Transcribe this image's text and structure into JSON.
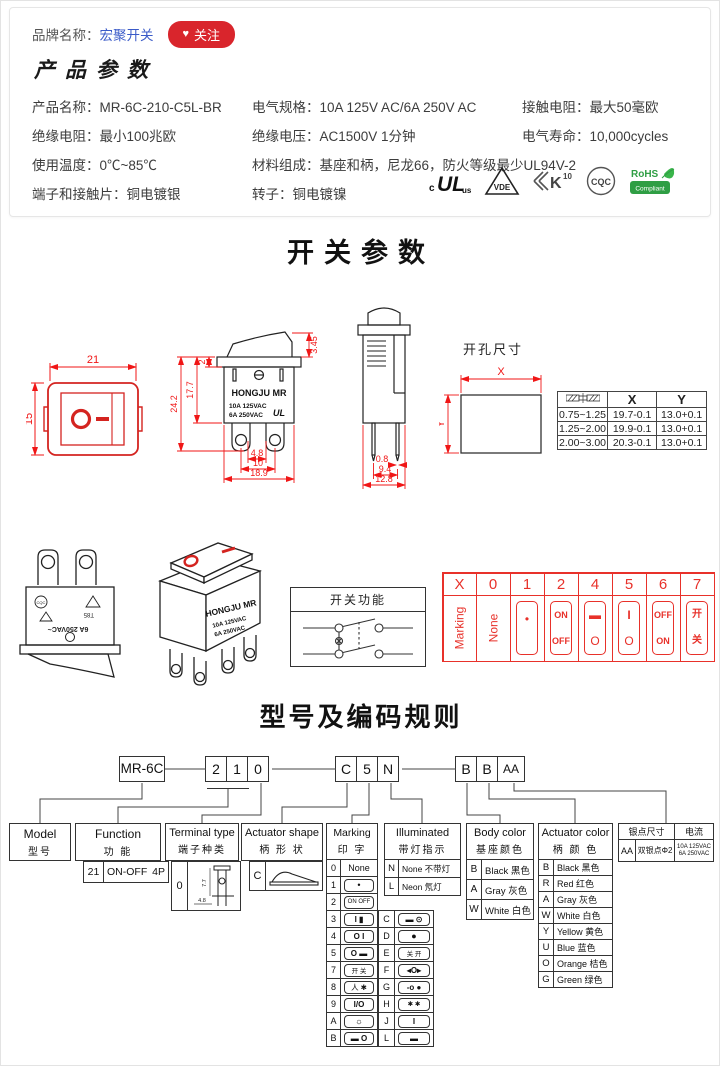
{
  "header": {
    "brand_label": "品牌名称：",
    "brand_name": "宏聚开关",
    "follow_label": "关注",
    "follow_heart": "♥"
  },
  "product": {
    "title": "产品参数",
    "specs": [
      {
        "label": "产品名称：",
        "value": "MR-6C-210-C5L-BR"
      },
      {
        "label": "电气规格：",
        "value": "10A 125V AC/6A 250V AC"
      },
      {
        "label": "接触电阻：",
        "value": "最大50毫欧"
      },
      {
        "label": "绝缘电阻：",
        "value": "最小100兆欧"
      },
      {
        "label": "绝缘电压：",
        "value": "AC1500V 1分钟"
      },
      {
        "label": "电气寿命：",
        "value": "10,000cycles"
      },
      {
        "label": "使用温度：",
        "value": "0℃~85℃"
      },
      {
        "label": "材料组成：",
        "value": "基座和柄，尼龙66，防火等级最少UL94V-2"
      },
      {
        "label": "端子和接触片：",
        "value": "铜电镀银"
      },
      {
        "label": "转子：",
        "value": "铜电镀镍"
      }
    ],
    "certs": {
      "ul_c": "c",
      "ul": "UL",
      "ul_us": "us",
      "vde": "VDE",
      "k": "K",
      "k10": "10",
      "cqc": "CQC",
      "rohs": "RoHS",
      "rohs_sub": "Compliant"
    }
  },
  "switch_section": {
    "title": "开关参数",
    "front": {
      "w": "21",
      "h": "15"
    },
    "side": {
      "tilt": "3.45",
      "flange": "2",
      "body_h": "17.7",
      "total_h": "24.2",
      "pin_gap": "4.8",
      "pin_pitch": "10",
      "width": "18.9",
      "brand": "HONGJU MR",
      "rating1": "10A 125VAC",
      "rating2": "6A 250VAC",
      "ul": "UL"
    },
    "end": {
      "pin_w": "0.8",
      "pin_pitch": "9.4",
      "width": "12.8"
    },
    "hole": {
      "title": "开孔尺寸",
      "x": "X",
      "y": "Y",
      "table": {
        "c1": "X",
        "c2": "Y",
        "rows": [
          {
            "t": "0.75~1.25",
            "x": "19.7-0.1",
            "y": "13.0+0.1"
          },
          {
            "t": "1.25~2.00",
            "x": "19.9-0.1",
            "y": "13.0+0.1"
          },
          {
            "t": "2.00~3.00",
            "x": "20.3-0.1",
            "y": "13.0+0.1"
          }
        ]
      }
    }
  },
  "middle": {
    "inv": {
      "rating": "6A 250VAC~",
      "t85": "T85",
      "cqc": "CQC"
    },
    "sw3d": {
      "brand": "HONGJU MR",
      "rating1": "10A 125VAC",
      "rating2": "6A 250VAC"
    },
    "func": {
      "title": "开关功能"
    }
  },
  "marking": {
    "headers": [
      "X",
      "0",
      "1",
      "2",
      "4",
      "5",
      "6",
      "7"
    ],
    "row_label": "Marking",
    "none": "None",
    "cells": [
      {
        "top": "•",
        "bottom": ""
      },
      {
        "top": "ON",
        "bottom": "OFF"
      },
      {
        "top": "▬",
        "bottom": "O"
      },
      {
        "top": "I",
        "bottom": "O"
      },
      {
        "top": "OFF",
        "bottom": "ON"
      },
      {
        "top": "开",
        "bottom": "关"
      }
    ]
  },
  "coding": {
    "title": "型号及编码规则",
    "boxes": {
      "model": "MR-6C",
      "g1": [
        "2",
        "1",
        "0"
      ],
      "g2": [
        "C",
        "5",
        "N"
      ],
      "g3": [
        "B",
        "B",
        "AA"
      ]
    },
    "model_col": {
      "en": "Model",
      "cn": "型号"
    },
    "function_col": {
      "en": "Function",
      "cn": "功  能",
      "code": "21",
      "value": "ON-OFF",
      "poles": "4P"
    },
    "terminal_col": {
      "en": "Terminal type",
      "cn": "端子种类",
      "code": "0",
      "dim_v": "7.7",
      "dim_h": "4.8"
    },
    "shape_col": {
      "en": "Actuator shape",
      "cn": "柄 形 状",
      "code": "C"
    },
    "marking_col": {
      "en": "Marking",
      "cn": "印  字",
      "rows_a": [
        {
          "code": "0",
          "glyph": "None"
        },
        {
          "code": "1",
          "glyph": "•"
        },
        {
          "code": "2",
          "glyph": "ON OFF"
        },
        {
          "code": "3",
          "glyph": "I ▮"
        },
        {
          "code": "4",
          "glyph": "O I"
        },
        {
          "code": "5",
          "glyph": "O ▬"
        },
        {
          "code": "7",
          "glyph": "开 关"
        },
        {
          "code": "8",
          "glyph": "人 ✱"
        },
        {
          "code": "9",
          "glyph": "I/O"
        },
        {
          "code": "A",
          "glyph": "☼"
        },
        {
          "code": "B",
          "glyph": "▬ O"
        }
      ],
      "rows_b": [
        {
          "code": "C",
          "glyph": "▬ ⊙"
        },
        {
          "code": "D",
          "glyph": "●"
        },
        {
          "code": "E",
          "glyph": "关 开"
        },
        {
          "code": "F",
          "glyph": "◂O▸"
        },
        {
          "code": "G",
          "glyph": "-o ●"
        },
        {
          "code": "H",
          "glyph": "✱ ✱"
        },
        {
          "code": "J",
          "glyph": "I"
        },
        {
          "code": "L",
          "glyph": "▬"
        }
      ]
    },
    "illum_col": {
      "en": "Illuminated",
      "cn": "带灯指示",
      "rows": [
        {
          "code": "N",
          "label": "None 不带灯"
        },
        {
          "code": "L",
          "label": "Neon 氖灯"
        }
      ]
    },
    "body_col": {
      "en": "Body color",
      "cn": "基座颜色",
      "rows": [
        {
          "code": "B",
          "label": "Black 黑色"
        },
        {
          "code": "A",
          "label": "Gray 灰色"
        },
        {
          "code": "W",
          "label": "White 白色"
        }
      ]
    },
    "act_col": {
      "en": "Actuator color",
      "cn": "柄 颜 色",
      "rows": [
        {
          "code": "B",
          "label": "Black 黑色"
        },
        {
          "code": "R",
          "label": "Red 红色"
        },
        {
          "code": "A",
          "label": "Gray 灰色"
        },
        {
          "code": "W",
          "label": "White 白色"
        },
        {
          "code": "Y",
          "label": "Yellow 黄色"
        },
        {
          "code": "U",
          "label": "Blue 蓝色"
        },
        {
          "code": "O",
          "label": "Orange 桔色"
        },
        {
          "code": "G",
          "label": "Green 绿色"
        }
      ]
    },
    "silver_col": {
      "h1": "银点尺寸",
      "h2": "电流",
      "code": "AA",
      "desc": "双银点Φ2",
      "cur1": "10A 125VAC",
      "cur2": "6A 250VAC"
    }
  }
}
